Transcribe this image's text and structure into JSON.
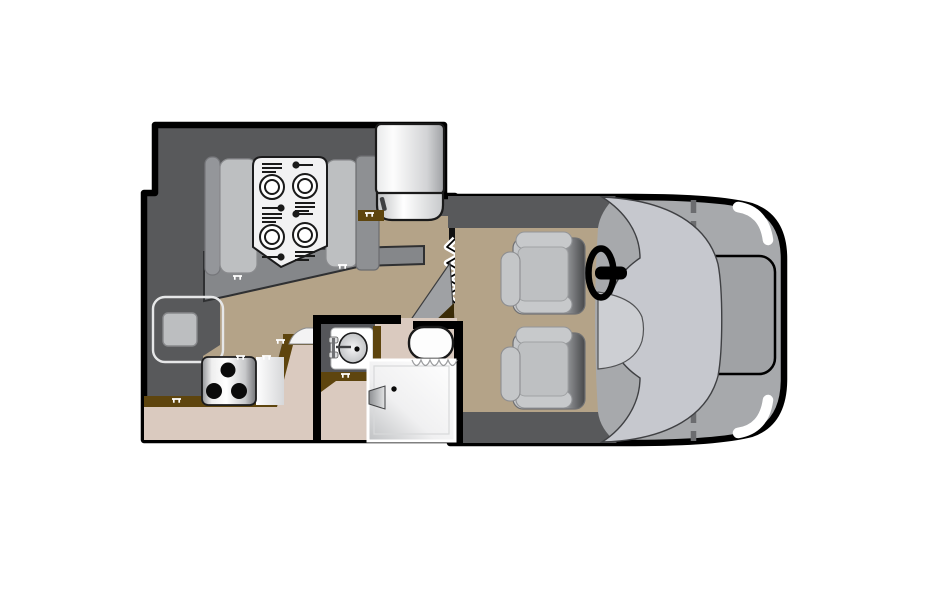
{
  "meta": {
    "type": "rv-floor-plan",
    "view": "top-down",
    "description": "Class C motorhome floor plan with dinette, kitchen, bathroom and driving cab"
  },
  "colors": {
    "bg": "#FFFFFF",
    "outline": "#000000",
    "wall": "#58595B",
    "platform": "#85878A",
    "floor_tan": "#B4A388",
    "floor_pink": "#DACABF",
    "counter_brown": "#5E450E",
    "bench_light": "#BDBFC1",
    "bench_dark": "#94969A",
    "wardrobe": "#8E9093",
    "table_white": "#F2F2F3",
    "cab_body": "#A7A9AC",
    "hood": "#A0A2A5",
    "windshield": "#C6C8CE",
    "console": "#CDCFD3",
    "dash_line": "#6B6C6F",
    "tv_screen": "#BCBEC0",
    "swing_gray": "#9FA1A4",
    "headlight": "#FFFFFF",
    "toilet": "#FDFDFD",
    "entry_black": "#111111",
    "dark_corner": "#3A2B07"
  },
  "rooms": [
    "dinette",
    "kitchen",
    "bathroom",
    "cab"
  ],
  "fixtures": [
    "dinette-table",
    "place-setting",
    "bench-seat",
    "refrigerator",
    "wardrobe-cabinet",
    "tv",
    "cooktop",
    "kitchen-counter",
    "bathroom-sink",
    "toilet",
    "shower",
    "shower-curtain",
    "entry-door",
    "door-swing",
    "driver-seat",
    "passenger-seat",
    "steering-wheel",
    "windshield",
    "hood",
    "headlight",
    "center-console"
  ]
}
